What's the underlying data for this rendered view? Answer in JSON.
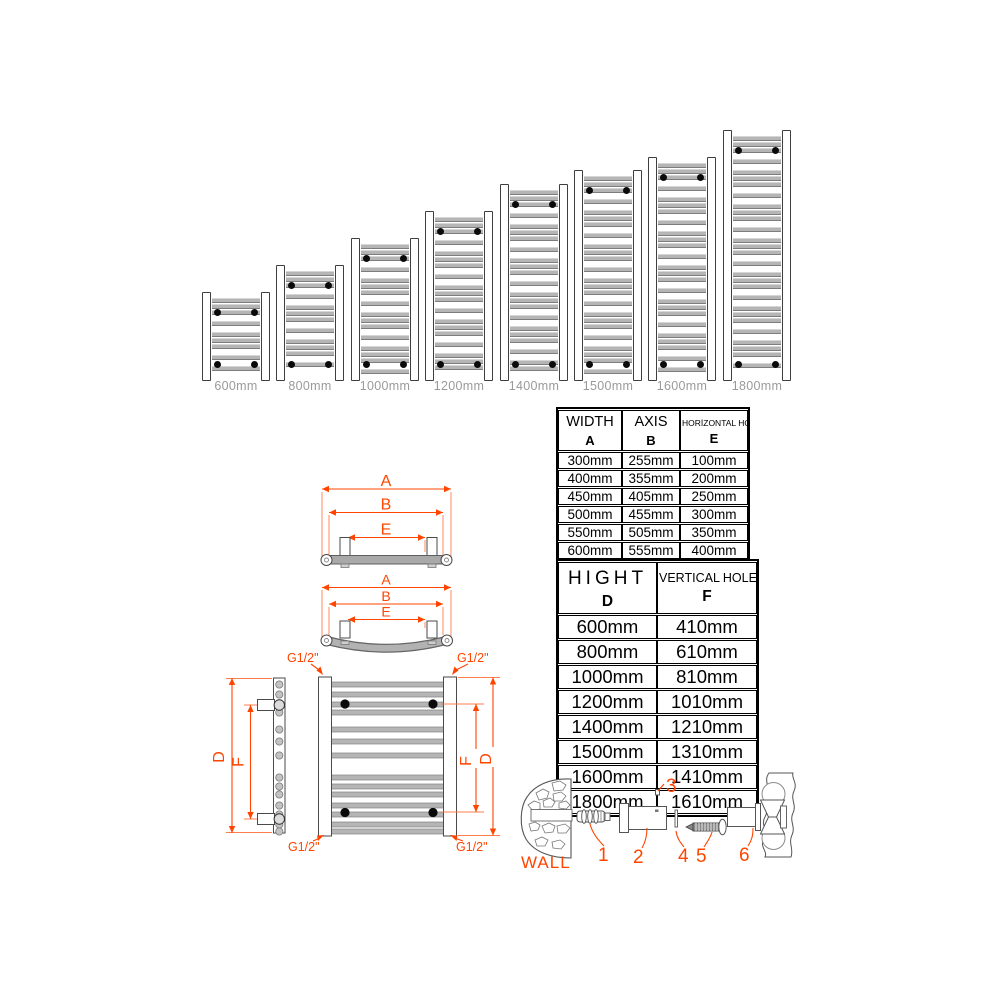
{
  "colors": {
    "accent": "#ff4500",
    "bar_gray": "#b5b5b5",
    "outline_dark": "#3f3f3f",
    "label_gray": "#9a9a9a"
  },
  "radiator_chart": {
    "items": [
      {
        "label": "600mm",
        "height_mm": 600
      },
      {
        "label": "800mm",
        "height_mm": 800
      },
      {
        "label": "1000mm",
        "height_mm": 1000
      },
      {
        "label": "1200mm",
        "height_mm": 1200
      },
      {
        "label": "1400mm",
        "height_mm": 1400
      },
      {
        "label": "1500mm",
        "height_mm": 1500
      },
      {
        "label": "1600mm",
        "height_mm": 1600
      },
      {
        "label": "1800mm",
        "height_mm": 1800
      }
    ]
  },
  "width_table": {
    "col_headers": [
      {
        "title": "WIDTH",
        "letter": "A"
      },
      {
        "title": "AXIS",
        "letter": "B"
      },
      {
        "title": "HORİZONTAL HOLES",
        "letter": "E"
      }
    ],
    "rows": [
      [
        "300mm",
        "255mm",
        "100mm"
      ],
      [
        "400mm",
        "355mm",
        "200mm"
      ],
      [
        "450mm",
        "405mm",
        "250mm"
      ],
      [
        "500mm",
        "455mm",
        "300mm"
      ],
      [
        "550mm",
        "505mm",
        "350mm"
      ],
      [
        "600mm",
        "555mm",
        "400mm"
      ]
    ]
  },
  "height_table": {
    "col_headers": [
      {
        "title": "HIGHT",
        "letter": "D"
      },
      {
        "title": "VERTICAL HOLES",
        "letter": "F"
      }
    ],
    "rows": [
      [
        "600mm",
        "410mm"
      ],
      [
        "800mm",
        "610mm"
      ],
      [
        "1000mm",
        "810mm"
      ],
      [
        "1200mm",
        "1010mm"
      ],
      [
        "1400mm",
        "1210mm"
      ],
      [
        "1500mm",
        "1310mm"
      ],
      [
        "1600mm",
        "1410mm"
      ],
      [
        "1800mm",
        "1610mm"
      ]
    ]
  },
  "dims": {
    "width_letter": "A",
    "axis_letter": "B",
    "horizontal_holes_letter": "E",
    "height_letter": "D",
    "vertical_holes_letter": "F",
    "thread_size": "G1/2\""
  },
  "hardware": {
    "wall_label": "WALL",
    "part_numbers": [
      "1",
      "2",
      "3",
      "4",
      "5",
      "6"
    ]
  }
}
